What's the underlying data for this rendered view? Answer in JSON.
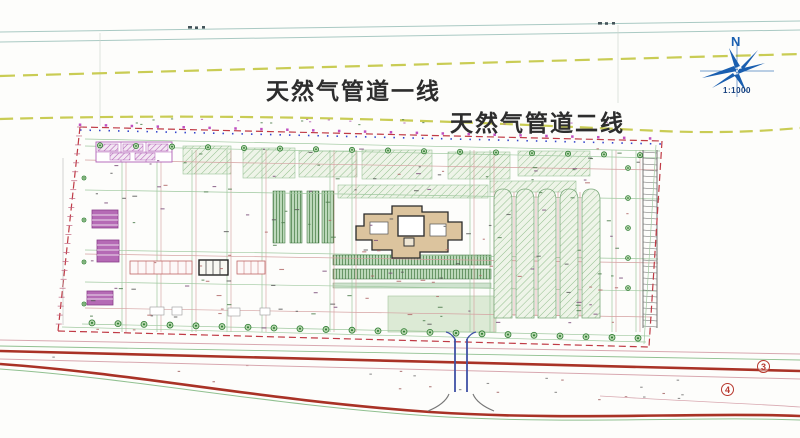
{
  "drawing": {
    "pipeline1_label": "天然气管道一线",
    "pipeline2_label": "天然气管道二线",
    "compass_north": "N",
    "compass_scale": "1:1000",
    "road_marker_a": "3",
    "road_marker_b": "4"
  },
  "colors": {
    "pipeline_dash": "#c6c94b",
    "boundary_red": "#c03a45",
    "boundary_blue": "#3344cc",
    "road_red": "#a93226",
    "green_line": "#9fc89f",
    "dark_green": "#2f6b2f",
    "utility_magenta": "#b05fb5",
    "building_tan": "#dcc49e",
    "compass_blue": "#1a5fb0",
    "marker_red": "#b7382e"
  }
}
